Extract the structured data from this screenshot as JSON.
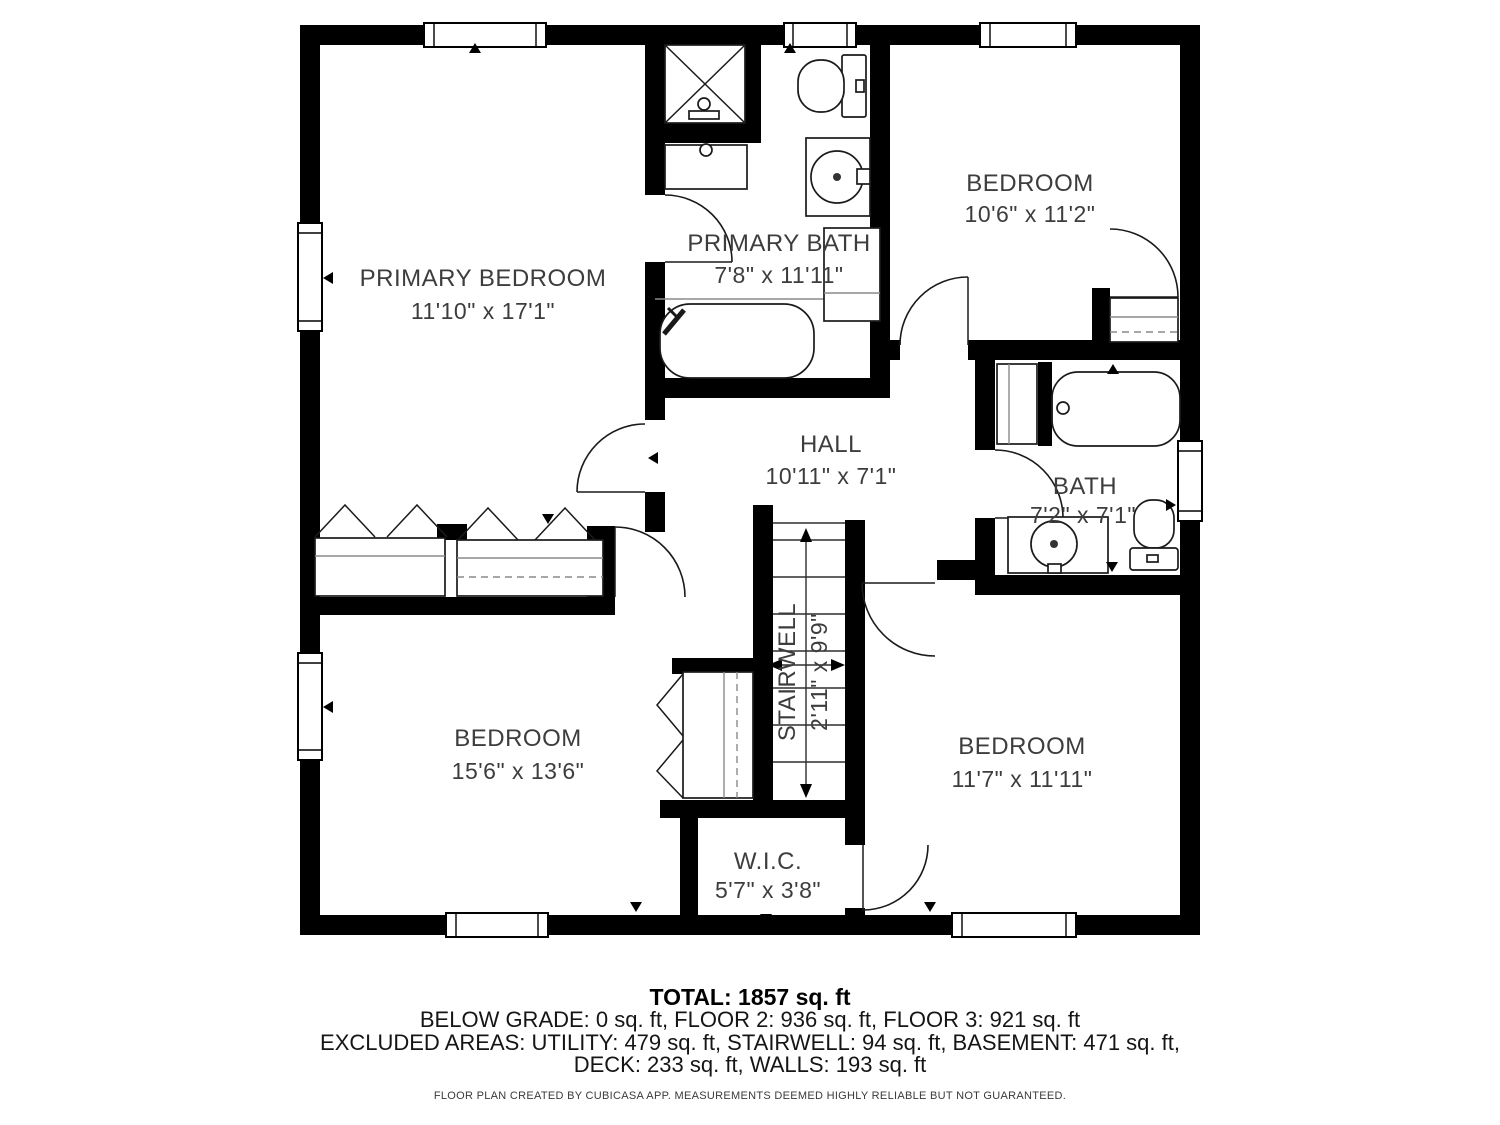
{
  "rooms": {
    "primary_bedroom": {
      "name": "PRIMARY BEDROOM",
      "dims": "11'10\" x 17'1\""
    },
    "primary_bath": {
      "name": "PRIMARY BATH",
      "dims": "7'8\" x 11'11\""
    },
    "bedroom_top_right": {
      "name": "BEDROOM",
      "dims": "10'6\" x 11'2\""
    },
    "hall": {
      "name": "HALL",
      "dims": "10'11\" x 7'1\""
    },
    "bath": {
      "name": "BATH",
      "dims": "7'2\" x 7'1\""
    },
    "stairwell": {
      "name": "STAIRWELL",
      "dims": "2'11\" x 9'9\""
    },
    "bedroom_bottom_left": {
      "name": "BEDROOM",
      "dims": "15'6\" x 13'6\""
    },
    "bedroom_bottom_right": {
      "name": "BEDROOM",
      "dims": "11'7\" x 11'11\""
    },
    "wic": {
      "name": "W.I.C.",
      "dims": "5'7\" x 3'8\""
    }
  },
  "footer": {
    "total": "TOTAL: 1857 sq. ft",
    "floors": "BELOW GRADE: 0 sq. ft, FLOOR 2: 936 sq. ft, FLOOR 3: 921 sq. ft",
    "excluded": "EXCLUDED AREAS: UTILITY: 479 sq. ft, STAIRWELL: 94 sq. ft, BASEMENT: 471 sq. ft,",
    "excluded2": "DECK: 233 sq. ft, WALLS: 193 sq. ft",
    "disclaimer": "FLOOR PLAN CREATED BY CUBICASA APP. MEASUREMENTS DEEMED HIGHLY RELIABLE BUT NOT GUARANTEED."
  },
  "colors": {
    "wall": "#000000",
    "label": "#3d3d3d",
    "background": "#ffffff"
  }
}
